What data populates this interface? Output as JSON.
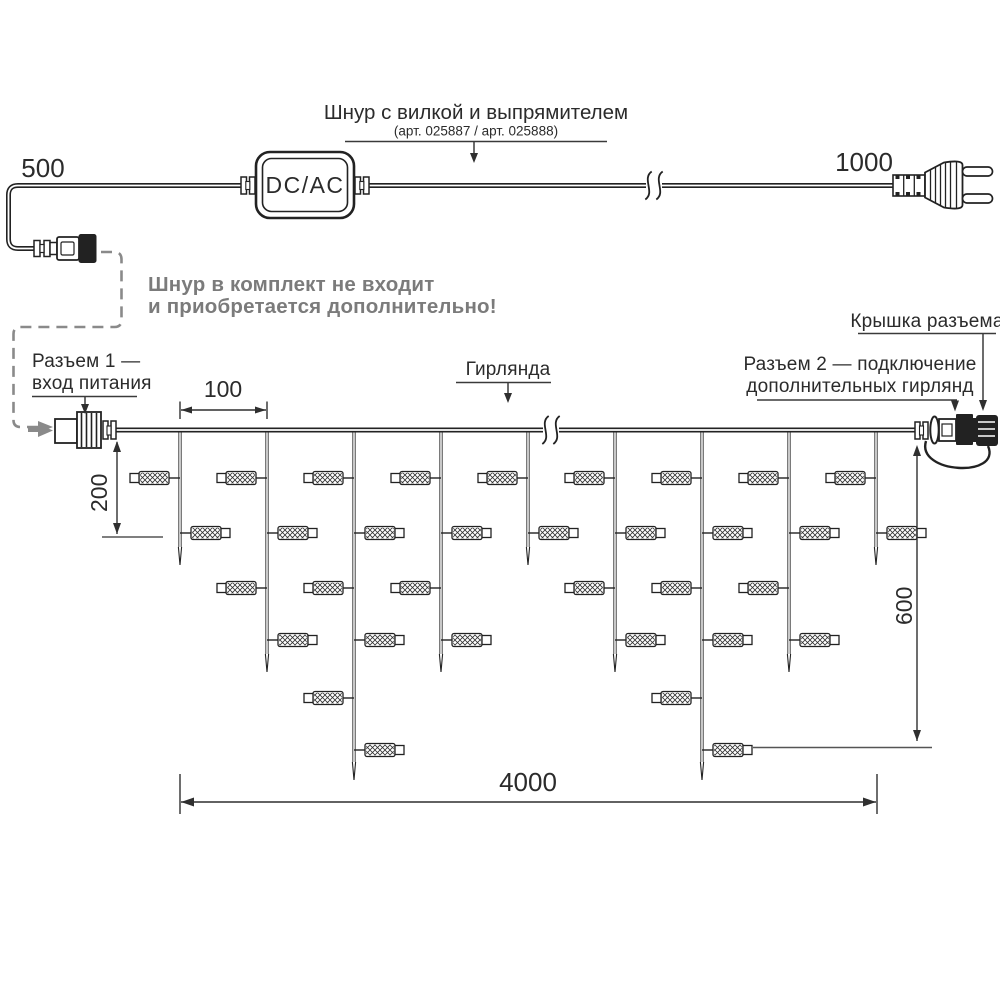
{
  "header": {
    "title": "Шнур с вилкой и выпрямителем",
    "subtitle": "(арт. 025887 / арт. 025888)"
  },
  "cord": {
    "dim_left": "500",
    "dim_right": "1000",
    "converter": "DC/AC"
  },
  "note": {
    "line1": "Шнур в комплект не входит",
    "line2": "и приобретается дополнительно!"
  },
  "labels": {
    "connector1_line1": "Разъем 1 —",
    "connector1_line2": "вход питания",
    "garland": "Гирлянда",
    "connector2_line1": "Разъем 2 — подключение",
    "connector2_line2": "дополнительных гирлянд",
    "cap": "Крышка разъема"
  },
  "dims": {
    "drop_spacing": "100",
    "short_drop": "200",
    "long_drop": "600",
    "total": "4000"
  },
  "colors": {
    "line": "#222222",
    "gray": "#7b7b7b"
  },
  "garland": {
    "wire_y": 430,
    "drop_xs": [
      180,
      267,
      354,
      441,
      528,
      615,
      702,
      789,
      876
    ],
    "pattern": [
      "short",
      "medium",
      "long",
      "medium",
      "short",
      "medium",
      "long",
      "medium",
      "short"
    ],
    "bulb_levels_y": [
      478,
      533,
      588,
      640,
      698,
      750
    ],
    "bulbs_per_type": {
      "short": 2,
      "medium": 4,
      "long": 6
    },
    "tip_y": {
      "short": 565,
      "medium": 672,
      "long": 780
    }
  },
  "breaks": [
    {
      "x": 654,
      "y": 185.5
    },
    {
      "x": 551,
      "y": 430
    }
  ]
}
